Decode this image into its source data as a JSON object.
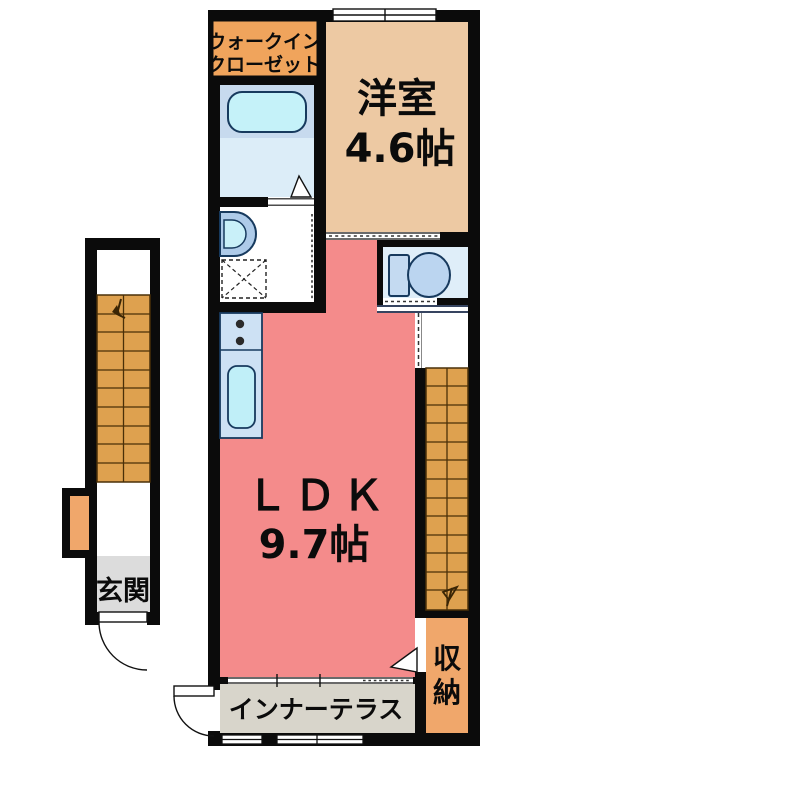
{
  "title": "間取り図",
  "rooms": {
    "walk_in_closet": {
      "label_line1": "ウォークイン",
      "label_line2": "クローゼット"
    },
    "western_room": {
      "name": "洋室",
      "size": "4.6帖"
    },
    "ldk": {
      "name": "ＬＤＫ",
      "size": "9.7帖"
    },
    "entrance": {
      "name": "玄関"
    },
    "storage": {
      "name": "収納",
      "char1": "収",
      "char2": "納"
    },
    "inner_terrace": {
      "name": "インナーテラス"
    }
  },
  "fixtures": [
    "bathtub",
    "washbasin",
    "washing-machine-pan",
    "kitchen-counter",
    "stove-burners",
    "kitchen-sink",
    "toilet",
    "staircase-left",
    "staircase-right",
    "entrance-door",
    "terrace-door",
    "storage-door",
    "bathroom-door",
    "sliding-doors",
    "windows"
  ],
  "colors": {
    "wall": "#0b0b0b",
    "western_room_floor": "#EDC9A3",
    "ldk_floor": "#F48B8B",
    "closet_label_box": "#F0A45C",
    "stairs": "#DEA14F",
    "storage_floor": "#F0A76B",
    "bath_upper": "#C7DAEE",
    "bath_lower": "#DCEDF8",
    "bathtub": "#C5F2F9",
    "toilet_floor": "#DFEEF9",
    "toilet_fixture": "#BBD5F0",
    "kitchen_counter": "#CDE1F4",
    "kitchen_sink": "#C0EFF8",
    "terrace_floor": "#D8D5CB",
    "entrance_floor": "#DCDCDC",
    "fixture_outline": "#173A5E"
  }
}
